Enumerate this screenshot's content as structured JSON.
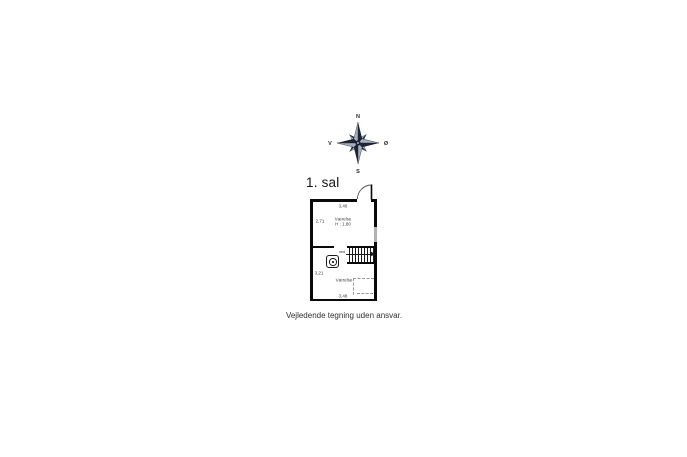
{
  "page": {
    "title": "1. sal",
    "disclaimer": "Vejledende tegning uden ansvar."
  },
  "compass": {
    "north": "N",
    "south": "S",
    "west": "V",
    "east": "Ø"
  },
  "floorplan": {
    "upper_room": {
      "name": "Værelse",
      "ceiling_height": "H : 1,80",
      "width_m": "3,48",
      "depth_m": "2,71"
    },
    "lower_room": {
      "name": "Værelse",
      "width_m": "3,48",
      "depth_m": "3,21"
    },
    "stairs_label": "ned",
    "colors": {
      "wall": "#0a0a0a",
      "window_gray": "#b3b3b3",
      "dash_gray": "#9a9a9a",
      "compass_dark": "#1e2433",
      "compass_light": "#a7aebf"
    }
  }
}
